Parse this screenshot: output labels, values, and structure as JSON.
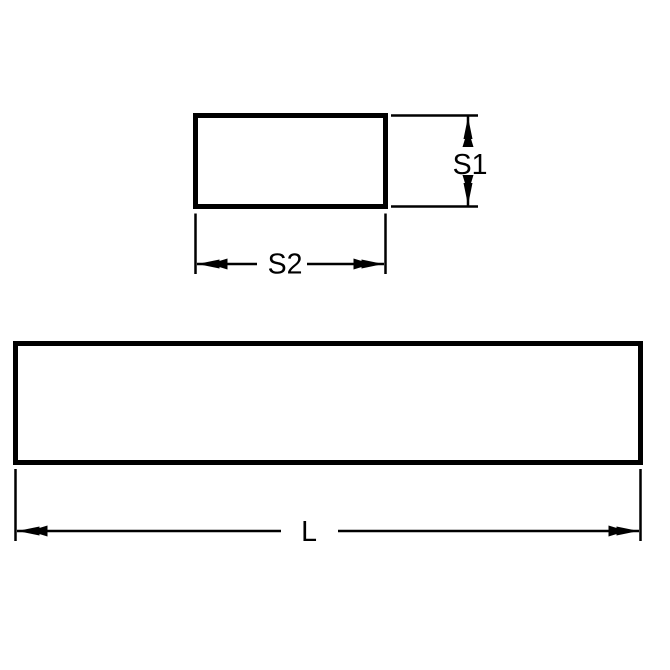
{
  "diagram": {
    "colors": {
      "line": "#000000",
      "background": "#ffffff"
    },
    "cross_section_view": {
      "height_label": "S1",
      "width_label": "S2"
    },
    "length_view": {
      "length_label": "L"
    }
  }
}
